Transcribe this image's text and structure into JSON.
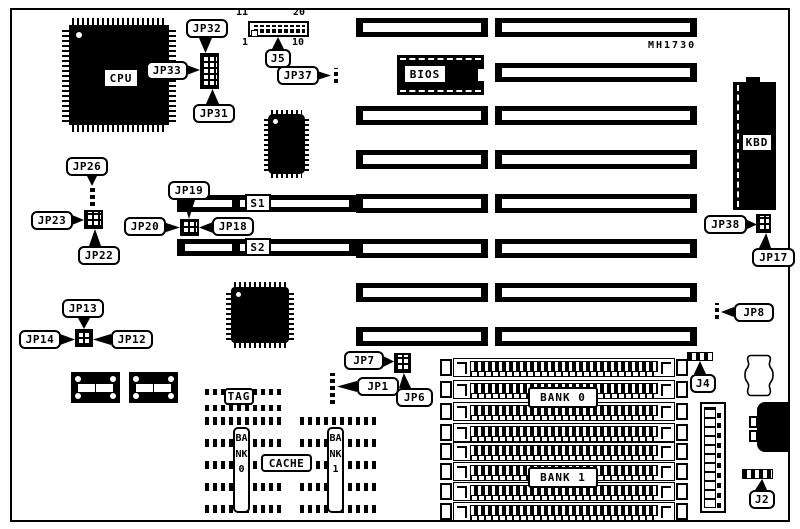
{
  "board": {
    "model": "MH1730"
  },
  "chips": {
    "cpu": "CPU",
    "bios": "BIOS",
    "kbd": "KBD"
  },
  "slots": {
    "s1": "S1",
    "s2": "S2"
  },
  "memory": {
    "tag": "TAG",
    "cache": "CACHE",
    "cache_bank0": "BANK0",
    "cache_bank1": "BANK1",
    "simm_bank0": "BANK 0",
    "simm_bank1": "BANK 1"
  },
  "connectors": {
    "j5": "J5",
    "j4": "J4",
    "j2": "J2"
  },
  "j5_pins": {
    "top_left": "11",
    "top_right": "20",
    "bottom_left": "1",
    "bottom_right": "10"
  },
  "jumpers": {
    "jp32": "JP32",
    "jp33": "JP33",
    "jp31": "JP31",
    "jp37": "JP37",
    "jp26": "JP26",
    "jp23": "JP23",
    "jp22": "JP22",
    "jp19": "JP19",
    "jp20": "JP20",
    "jp18": "JP18",
    "jp13": "JP13",
    "jp14": "JP14",
    "jp12": "JP12",
    "jp38": "JP38",
    "jp17": "JP17",
    "jp8": "JP8",
    "jp7": "JP7",
    "jp1": "JP1",
    "jp6": "JP6"
  }
}
